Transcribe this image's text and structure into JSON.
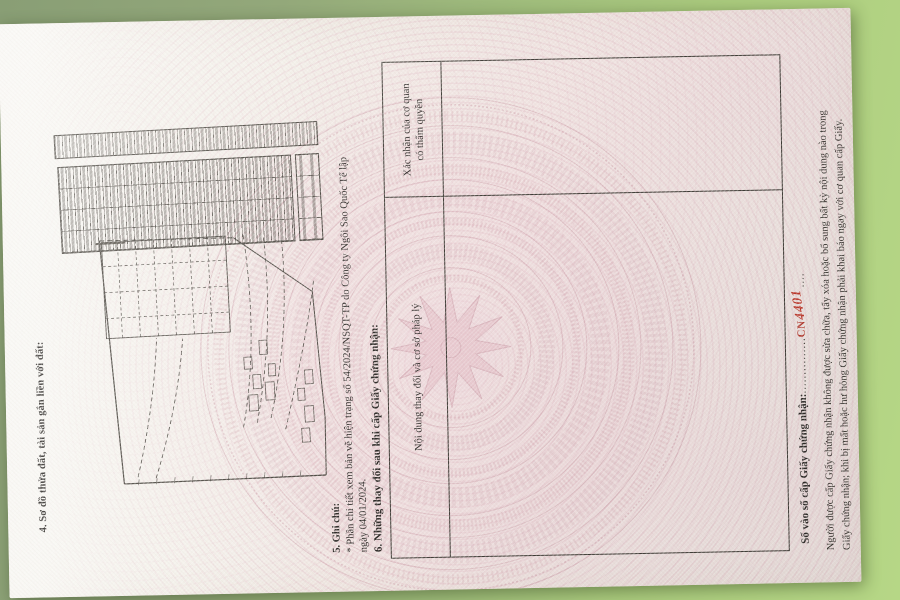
{
  "certificate": {
    "section4_title": "4. Sơ đồ thửa đất, tài sản gắn liền với đất:",
    "section5": {
      "title": "5. Ghi chú:",
      "line1": "* Phần chi tiết xem bản vẽ hiện trạng số 54/2024/NSQT-TP do Công ty Ngôi Sao Quốc Tế lập",
      "line2": "ngày 04/01/2024."
    },
    "section6": {
      "title": "6. Những thay đổi sau khi cấp Giấy chứng nhận:",
      "column_left_header": "Nội dung thay đổi và cơ sở pháp lý",
      "column_right_header_line1": "Xác nhận của cơ quan",
      "column_right_header_line2": "có thẩm quyền"
    },
    "footer": {
      "register_label": "Số vào sổ cấp Giấy chứng nhận:",
      "leader_dots": "...............",
      "cn_prefix": "CN",
      "cn_number_handwritten": "4401",
      "trailing_dots": "....",
      "note_line1": "Người được cấp Giấy chứng nhận không được sửa chữa, tẩy xóa hoặc bổ sung bất kỳ nội dung nào trong",
      "note_line2": "Giấy chứng nhận; khi bị mất hoặc hư hỏng Giấy chứng nhận phải khai báo ngay với cơ quan cấp Giấy."
    },
    "colors": {
      "paper": "#f2eee7",
      "pattern_pink": "#dcb3bb",
      "background_green": "#a3c17e",
      "accent_red": "#b5372b",
      "ink": "#2e2b28"
    }
  }
}
